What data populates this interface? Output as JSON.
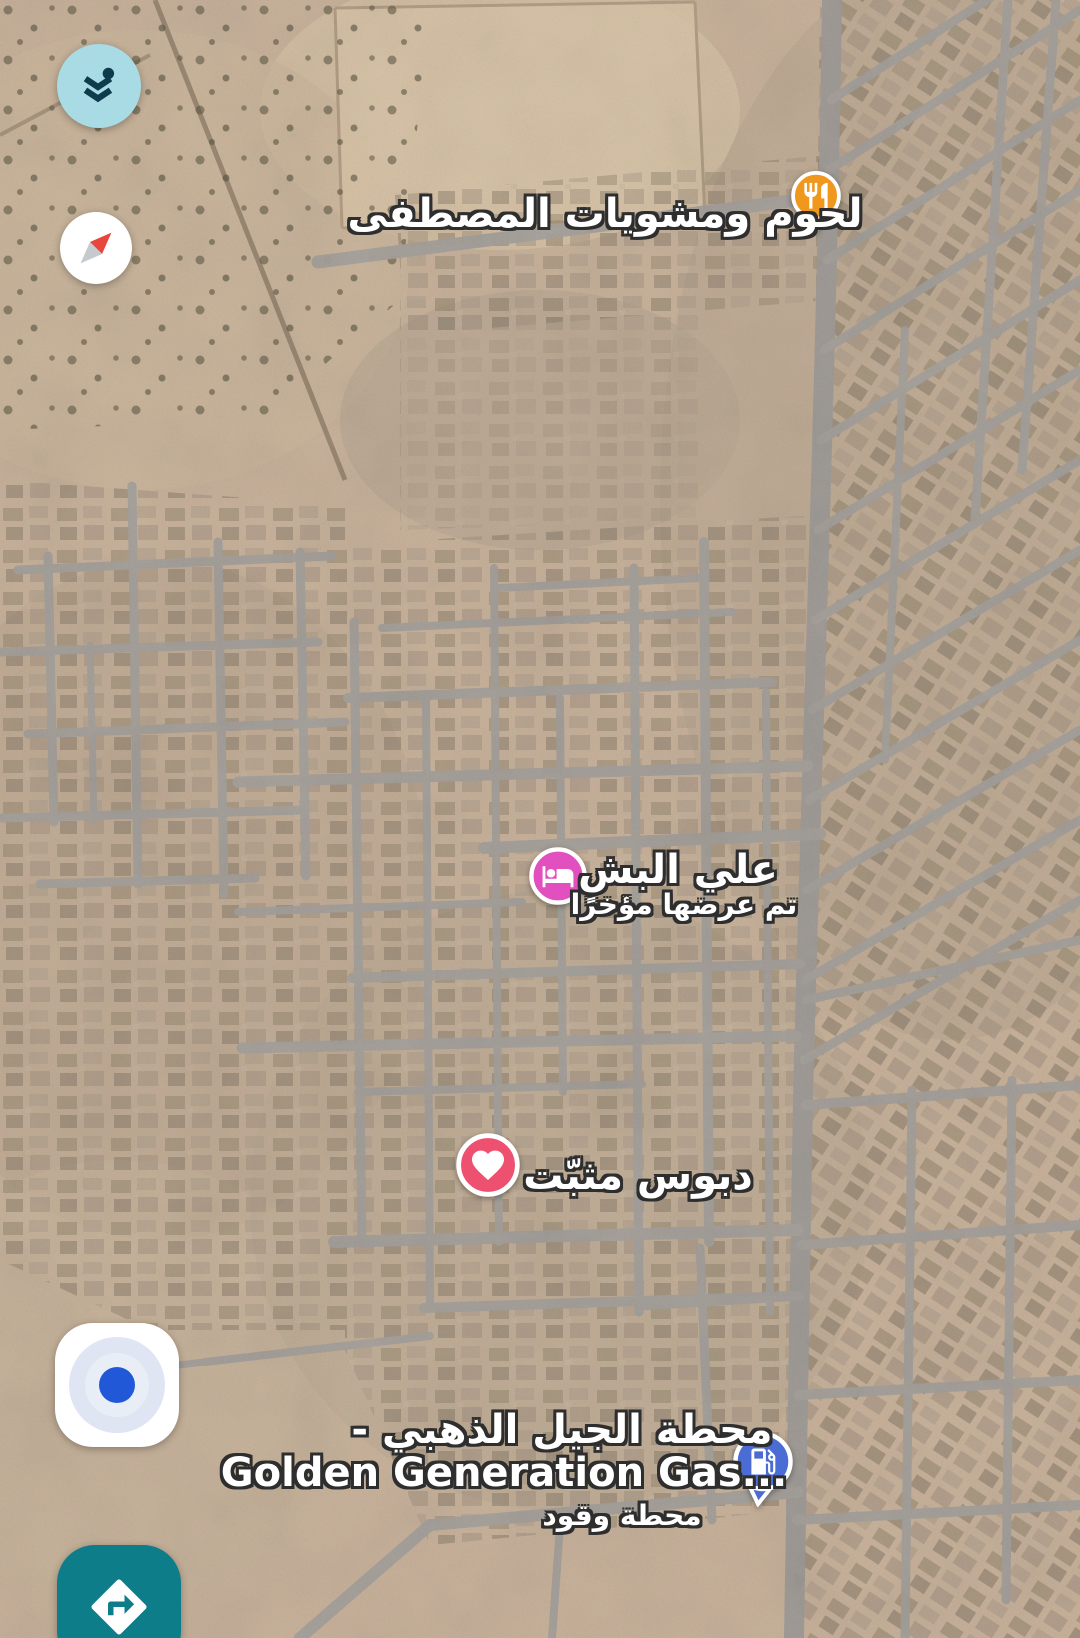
{
  "map": {
    "view_type": "satellite",
    "road_color": "#A6A29D",
    "terrain_color": "#C9B39C"
  },
  "controls": {
    "layers": {
      "icon": "layers-icon",
      "bg_color": "#A9DBE4",
      "icon_color": "#0E3C4C"
    },
    "compass": {
      "icon": "compass-icon",
      "north_color": "#E8453C",
      "south_color": "#C6CACF"
    },
    "my_location": {
      "icon": "my-location-icon",
      "dot_color": "#2158D8"
    },
    "directions": {
      "icon": "directions-icon",
      "bg_color": "#0E7D8A",
      "icon_color": "#FFFFFF"
    }
  },
  "markers": {
    "restaurant": {
      "type": "restaurant",
      "icon": "restaurant-icon",
      "color": "#F0971E",
      "label": "لحوم ومشويات المصطفى"
    },
    "hotel": {
      "type": "lodging",
      "icon": "bed-icon",
      "color": "#E24FBE",
      "label": "علي البش",
      "sublabel": "تم عرضها مؤخرًا"
    },
    "pinned": {
      "type": "saved-favorite",
      "icon": "heart-icon",
      "color": "#EE5170",
      "label": "دبوس مثبّت"
    },
    "gas_station": {
      "type": "gas-station",
      "icon": "gas-pump-icon",
      "color": "#4A6CD4",
      "label_arabic": "محطة الجيل الذهبي -",
      "label_latin": "Golden Generation Gas...",
      "sublabel": "محطة وقود"
    }
  }
}
